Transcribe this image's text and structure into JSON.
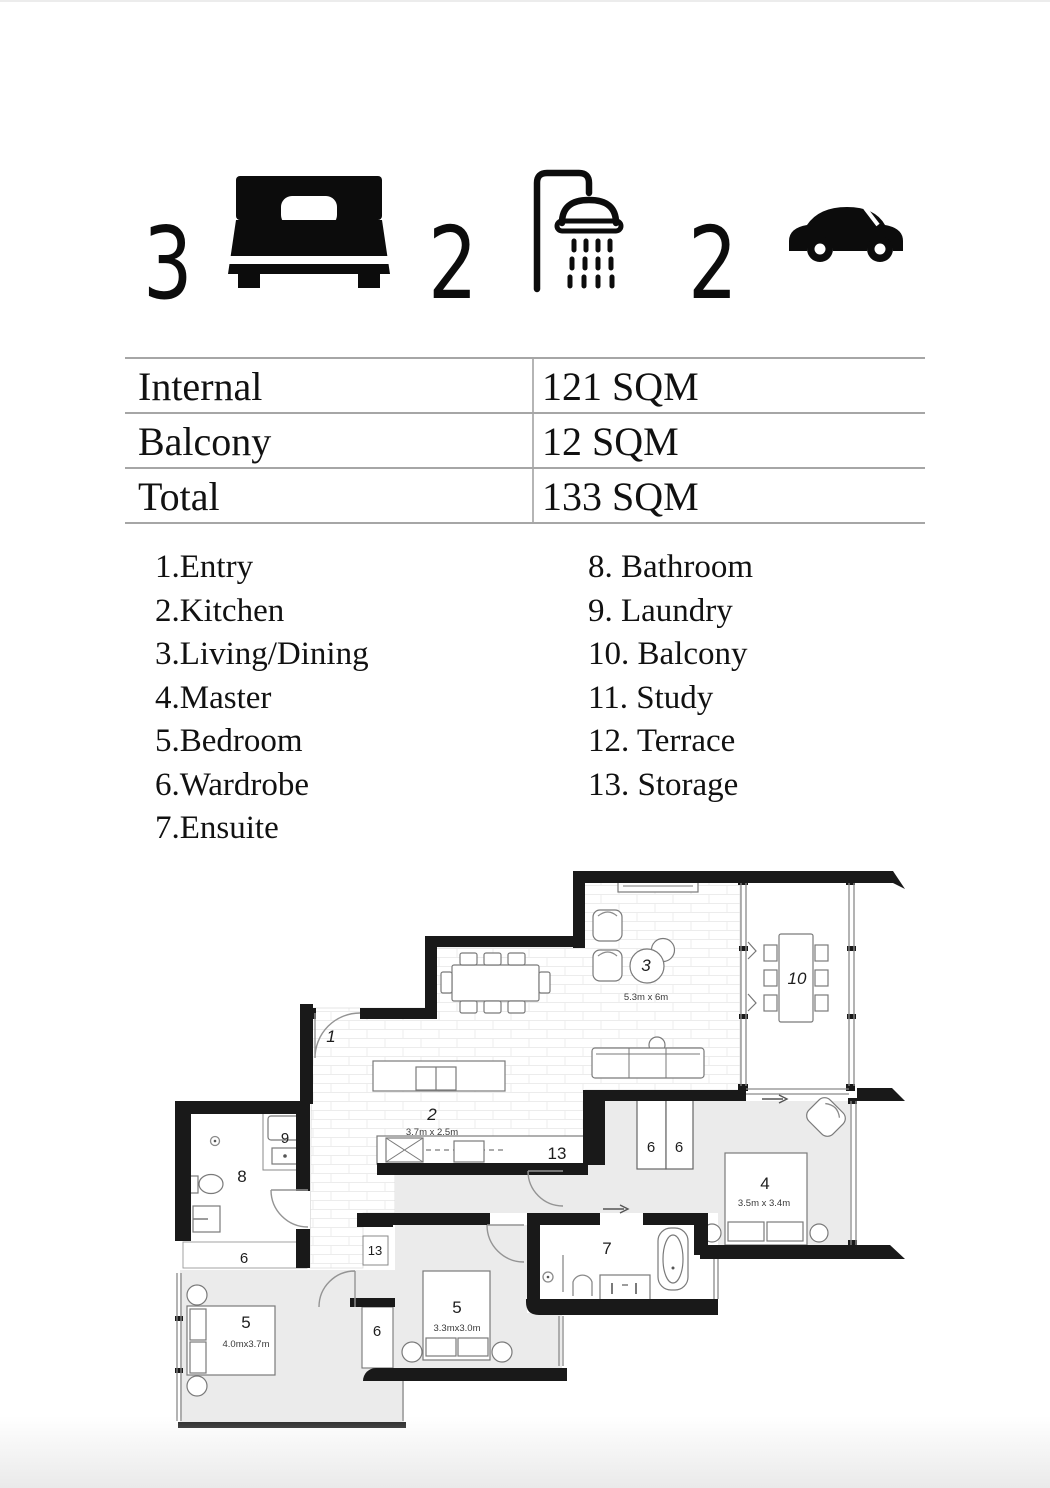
{
  "stats": {
    "bedrooms": "3",
    "bathrooms": "2",
    "car_spaces": "2"
  },
  "area_table": {
    "rows": [
      {
        "label": "Internal",
        "value": "121 SQM"
      },
      {
        "label": "Balcony",
        "value": "12 SQM"
      },
      {
        "label": "Total",
        "value": "133 SQM"
      }
    ]
  },
  "legend": {
    "left": [
      "1.Entry",
      "2.Kitchen",
      "3.Living/Dining",
      "4.Master",
      "5.Bedroom",
      "6.Wardrobe",
      "7.Ensuite"
    ],
    "right": [
      "8. Bathroom",
      "9. Laundry",
      "10. Balcony",
      "11. Study",
      "12. Terrace",
      "13. Storage"
    ]
  },
  "floorplan": {
    "labels": {
      "entry": "1",
      "kitchen": "2",
      "living": "3",
      "master": "4",
      "bedroom": "5",
      "wardrobe": "6",
      "ensuite": "7",
      "bathroom": "8",
      "laundry": "9",
      "balcony": "10",
      "storage": "13"
    },
    "dims": {
      "living": "5.3m x 6m",
      "kitchen": "3.7m x 2.5m",
      "master": "3.5m x 3.4m",
      "bedroom_left": "4.0mx3.7m",
      "bedroom_mid": "3.3mx3.0m"
    }
  }
}
